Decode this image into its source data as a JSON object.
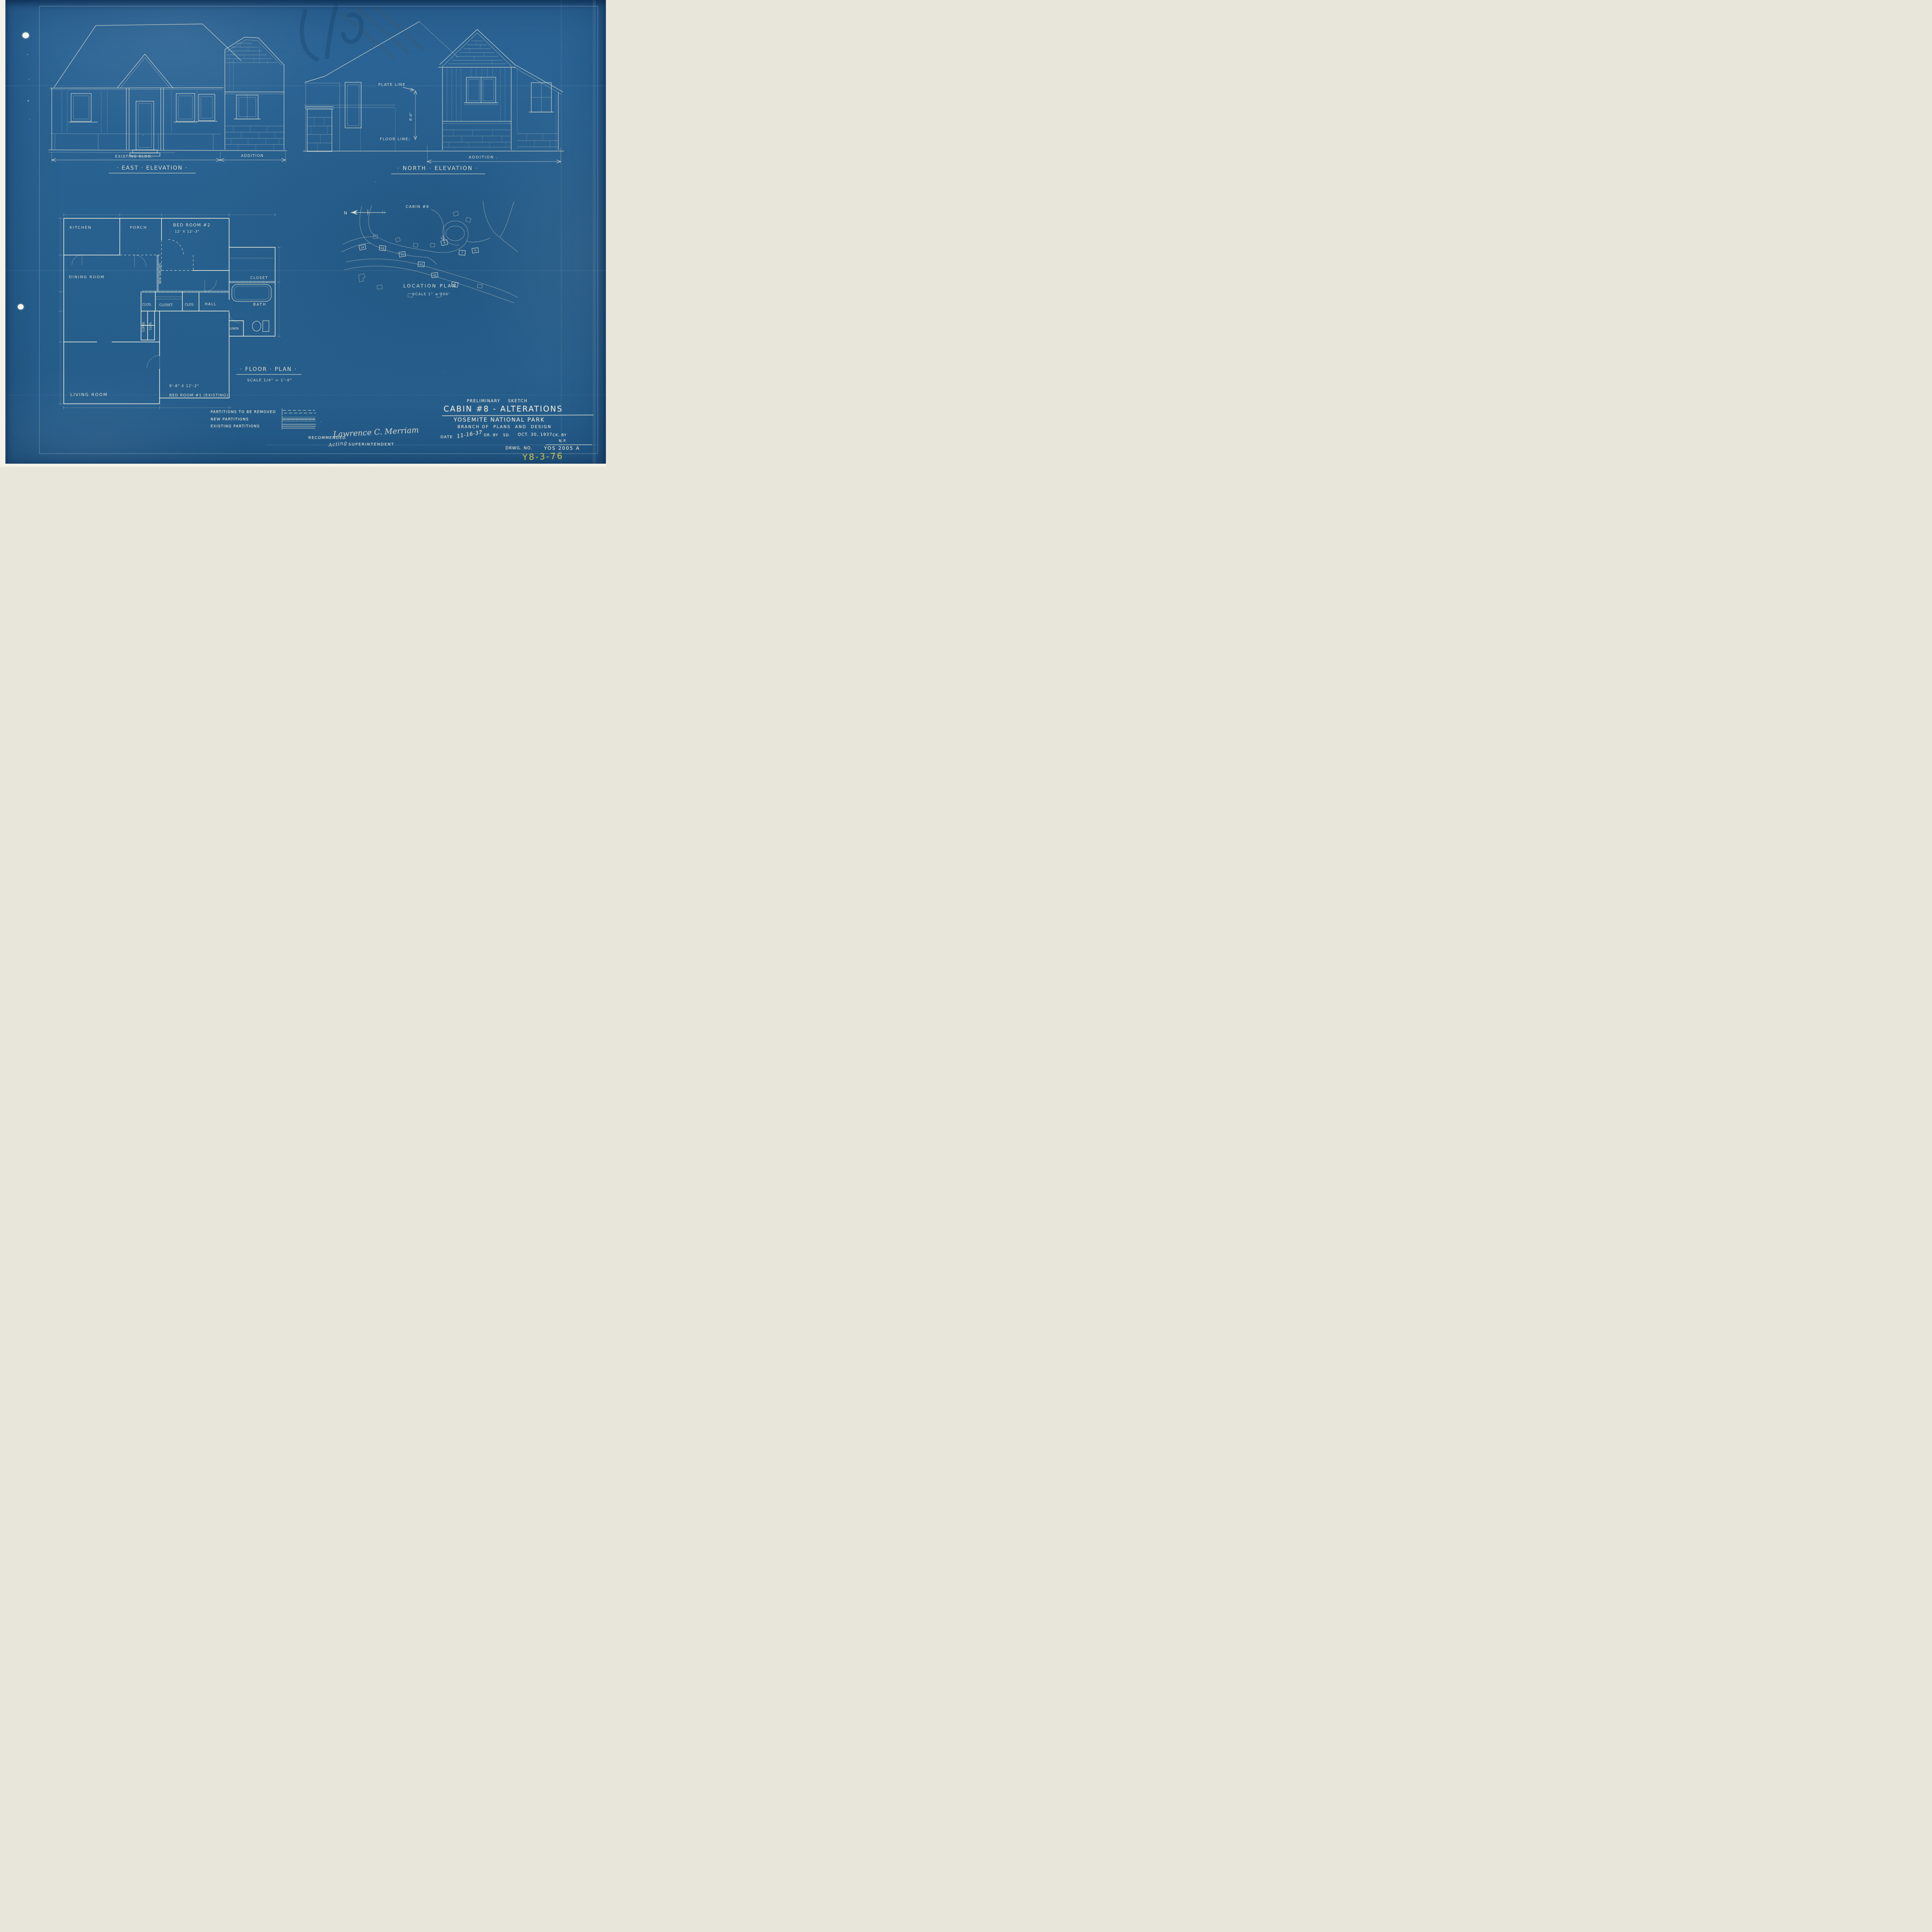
{
  "east_elevation": {
    "title": "· EAST · ELEVATION ·",
    "label_existing": "EXISTING BLDG.",
    "label_addition": "ADDITION"
  },
  "north_elevation": {
    "title": "· NORTH · ELEVATION ·",
    "plate_line": "PLATE LINE",
    "floor_line": "FLOOR LINE;",
    "height_dim": "8'-4\"",
    "label_addition": "ADDITION ."
  },
  "floor_plan": {
    "title": "· FLOOR · PLAN ·",
    "scale": "SCALE  1/4\" = 1'-0\"",
    "rooms": {
      "kitchen": "KITCHEN",
      "porch": "PORCH",
      "bedroom2": "BED ROOM #2",
      "bedroom2_size": "12' X 12'-3\"",
      "dining": "DINING ROOM",
      "clos_a": "CLOS.",
      "closet_b": "CLOSET.",
      "clos_c": "CLOS.",
      "hall": "HALL",
      "closet_wing": "CLOSET",
      "bath": "BATH",
      "linen": "LINEN",
      "cupbd": "CUPBD.",
      "clos_d": "CLOS.",
      "new_shelves": "NEW SHELVES",
      "living": "LIVING ROOM",
      "bedroom1_size": "9'-8\" X 12'-2\"",
      "bedroom1": "BED ROOM #1 (EXISTING)"
    }
  },
  "location_plan": {
    "title": "LOCATION  PLAN",
    "scale": "SCALE  1\" = 200'",
    "cabin_callout": "CABIN #8",
    "north": "N",
    "cabins": [
      "14",
      "13",
      "12",
      "11",
      "10",
      "9",
      "8",
      "7",
      "6"
    ]
  },
  "legend": {
    "items": [
      {
        "label": "PARTITIONS TO BE REMOVED",
        "symbol": "dashed-lines"
      },
      {
        "label": "NEW PARTITIONS",
        "symbol": "hatched-band"
      },
      {
        "label": "EXISTING PARTITIONS",
        "symbol": "solid-lines"
      }
    ]
  },
  "approval": {
    "recommended": "RECOMMENDED",
    "signature": "Lawrence C. Merriam",
    "acting": "Acting",
    "role": "SUPERINTENDENT",
    "date_label": "DATE",
    "date": "11-16-37"
  },
  "title_block": {
    "line1": "PRELIMINARY    SKETCH",
    "line2": "CABIN #8 - ALTERATIONS",
    "line3": "YOSEMITE NATIONAL PARK",
    "line4": "BRANCH OF  PLANS  AND  DESIGN",
    "drawn_label": "DR. BY",
    "drawn": "SD.",
    "date": "OCT. 30, 1937",
    "checked_label": "CK. BY",
    "np": "N.P.",
    "drawing_no_label": "DRWG. NO.",
    "drawing_no": "YOS 2005 A"
  },
  "stamp": "Y8-3-76",
  "colors": {
    "blueprint": "#27618f",
    "ink": "#eae7d4",
    "pencil_yellow": "#cdc24b",
    "paper": "#f4f1e8"
  }
}
